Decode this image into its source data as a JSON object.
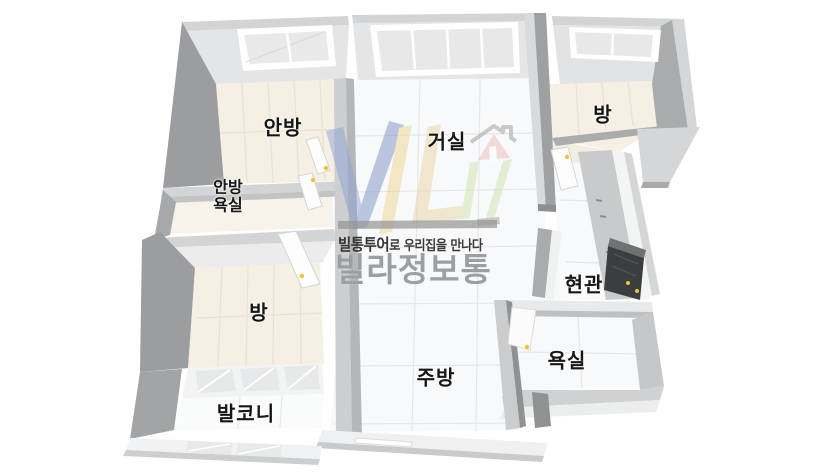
{
  "meta": {
    "type": "floorplan-3d",
    "language": "ko",
    "background": "#ffffff"
  },
  "rooms": {
    "master_bedroom": {
      "label": "안방"
    },
    "master_bathroom": {
      "label_line1": "안방",
      "label_line2": "욕실"
    },
    "living_room": {
      "label": "거실"
    },
    "bedroom_top_right": {
      "label": "방"
    },
    "entrance": {
      "label": "현관"
    },
    "bathroom": {
      "label": "욕실"
    },
    "kitchen": {
      "label": "주방"
    },
    "bedroom_bottom_left": {
      "label": "방"
    },
    "balcony": {
      "label": "발코니"
    }
  },
  "watermark": {
    "slogan_brand": "빌통투어",
    "slogan_rest": "로 우리집을 만나다",
    "brand_name": "빌라정보통",
    "logo_icon": "vil-house-logo"
  },
  "colors": {
    "wall_top": "#d3d4d5",
    "wall_light_face": "#ececec",
    "wall_dark_face": "#9b9da0",
    "floor_wood": "#f5f0e3",
    "floor_tile": "#f8f9fa",
    "entrance_door": "#3b3e41",
    "door_handle_yellow": "#f0c23c",
    "logo_blue": "#8fa5d6",
    "logo_yellow": "#eed592",
    "logo_red": "#f0b9bb",
    "logo_green": "#cde2a9",
    "watermark_gray": "#9c9e9f",
    "label_color": "#161616"
  }
}
